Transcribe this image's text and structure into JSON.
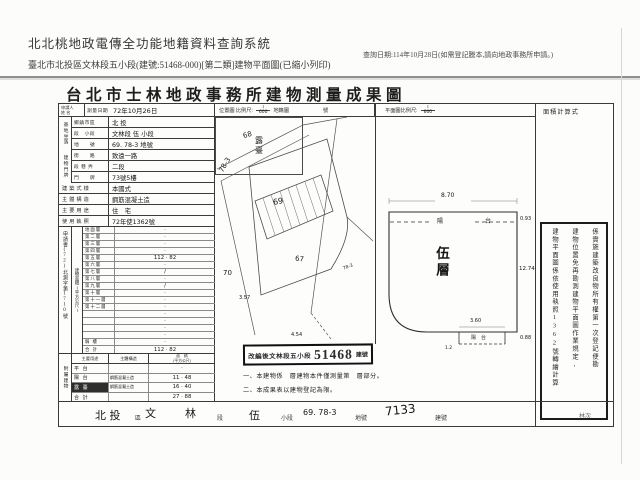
{
  "colors": {
    "paper": "#fcfcfa",
    "ink": "#2b2b2b",
    "stamp_ink": "#111111",
    "divider_gray": "#8f8f8f"
  },
  "header": {
    "system_title": "北北桃地政電傳全功能地籍資料查詢系統",
    "query_date": "查詢日期:114年10月28日(如需登記謄本,請向地政事務所申請。)",
    "subtitle": "臺北市北投區文林段五小段(建號:51468-000)[第二類]建物平面圖(已縮小列印)"
  },
  "document": {
    "title": "台北市士林地政事務所建物測量成果圖",
    "top_row": {
      "applicant_label": "申請人",
      "applicant_name_label": "姓 名",
      "survey_date_label": "測量日期",
      "survey_date_value": "72年10月26日",
      "location_map_label": "位置圖 比例尺:",
      "location_scale_num": "1",
      "location_scale_den": "600",
      "cadastral_label": "地籍圖",
      "cadastral_suffix": "號",
      "plan_scale_label": "平面圖比例尺:",
      "plan_scale_num": "1",
      "plan_scale_den": "600",
      "area_calc_label": "面積計算式"
    },
    "site": {
      "group_label": "基地坐落",
      "rows": [
        {
          "label": "鄉鎮市區",
          "value": "北 投"
        },
        {
          "label": "段　小段",
          "value": "文林段 伍 小段"
        },
        {
          "label": "地　　號",
          "value": "69. 78-3 地號"
        }
      ]
    },
    "address": {
      "group_label": "建物門牌",
      "rows": [
        {
          "label": "街　　路",
          "value": "致遠一路"
        },
        {
          "label": "段 巷 弄",
          "value": "二段"
        },
        {
          "label": "門　　牌",
          "value": "73號5樓"
        }
      ]
    },
    "attributes": {
      "rows": [
        {
          "label": "建築式樣",
          "value": "本國式"
        },
        {
          "label": "主體構造",
          "value": "鋼筋混凝土造"
        },
        {
          "label": "主要用途",
          "value": "住　宅"
        },
        {
          "label": "使用執照",
          "value": "72年使1362號"
        }
      ]
    },
    "floor_area": {
      "spine_label": "建物面積(平方公尺)",
      "application_no": "申請書(72)北測字第1710號",
      "rows": [
        {
          "label": "地面層",
          "value": "·"
        },
        {
          "label": "第二層",
          "value": "·"
        },
        {
          "label": "第三層",
          "value": "·"
        },
        {
          "label": "第四層",
          "value": "·"
        },
        {
          "label": "第五層",
          "value": "112 · 82"
        },
        {
          "label": "第六層",
          "value": "·"
        },
        {
          "label": "第七層",
          "value": "/"
        },
        {
          "label": "第八層",
          "value": "·"
        },
        {
          "label": "第九層",
          "value": "/"
        },
        {
          "label": "第十層",
          "value": "·"
        },
        {
          "label": "第十一層",
          "value": "·"
        },
        {
          "label": "第十二層",
          "value": "·"
        },
        {
          "label": "",
          "value": "·"
        },
        {
          "label": "",
          "value": "·"
        },
        {
          "label": "",
          "value": "·"
        },
        {
          "label": "",
          "value": "·"
        },
        {
          "label": "騎 樓",
          "value": "·"
        },
        {
          "label": "合 計",
          "value": "112 · 82"
        }
      ]
    },
    "annex": {
      "group_label": "附屬建物",
      "headers": {
        "use": "主要用途",
        "structure": "主體構造",
        "area_line1": "面　積",
        "area_line2": "(平方公尺)"
      },
      "rows": [
        {
          "use": "平 台",
          "structure": "",
          "area": "·"
        },
        {
          "use": "陽 台",
          "structure": "鋼筋混凝土造",
          "area": "11 · 48"
        },
        {
          "use": "露 臺",
          "structure": "鋼筋混凝土造",
          "area": "16 · 40",
          "dark": true
        },
        {
          "use": "合 計",
          "structure": "",
          "area": "27 · 88"
        }
      ]
    },
    "location_map": {
      "labels": {
        "p68": "68",
        "p78": "78-3",
        "p69": "69",
        "p70": "70",
        "p67": "67"
      },
      "sketch": {
        "label": "露臺",
        "dim_left": "3.57",
        "dim_bottom": "4.54",
        "corner_note": "78-3"
      }
    },
    "stamp": {
      "text": "改編後文林段五小段",
      "number": "51468",
      "suffix": "建號"
    },
    "notes": {
      "n1": "一、本建物係　層建物本件僅測量第　層部分。",
      "n2": "二、本成果表以建物登記為限。"
    },
    "floor_plan": {
      "room_label": "伍層",
      "balcony_top_label": "陽　台",
      "balcony_bottom_label": "陽台",
      "dim_top": "8.70",
      "dim_top_right": "0.93",
      "dim_right": "12.74",
      "dim_bottom_right": "0.88",
      "dim_balcony_width": "3.60",
      "dim_balcony_offset": "1.2"
    },
    "side_note": {
      "col1": "係實施建築改良物所有權第一次登記便勘",
      "col2": "建物位置免再勘測建物平面圖作業規定,",
      "col3": "建物平面圖係依使用執照1362號轉繪計算"
    },
    "recap": {
      "district": "北 投",
      "district_label": "區",
      "section": "文",
      "section2": "林",
      "section_label": "段",
      "subsection": "伍",
      "subsection_label": "小段",
      "lots": "69. 78-3",
      "lots_label": "地號",
      "building_no": "7133",
      "building_no_label": "建號",
      "check": "林次"
    }
  }
}
